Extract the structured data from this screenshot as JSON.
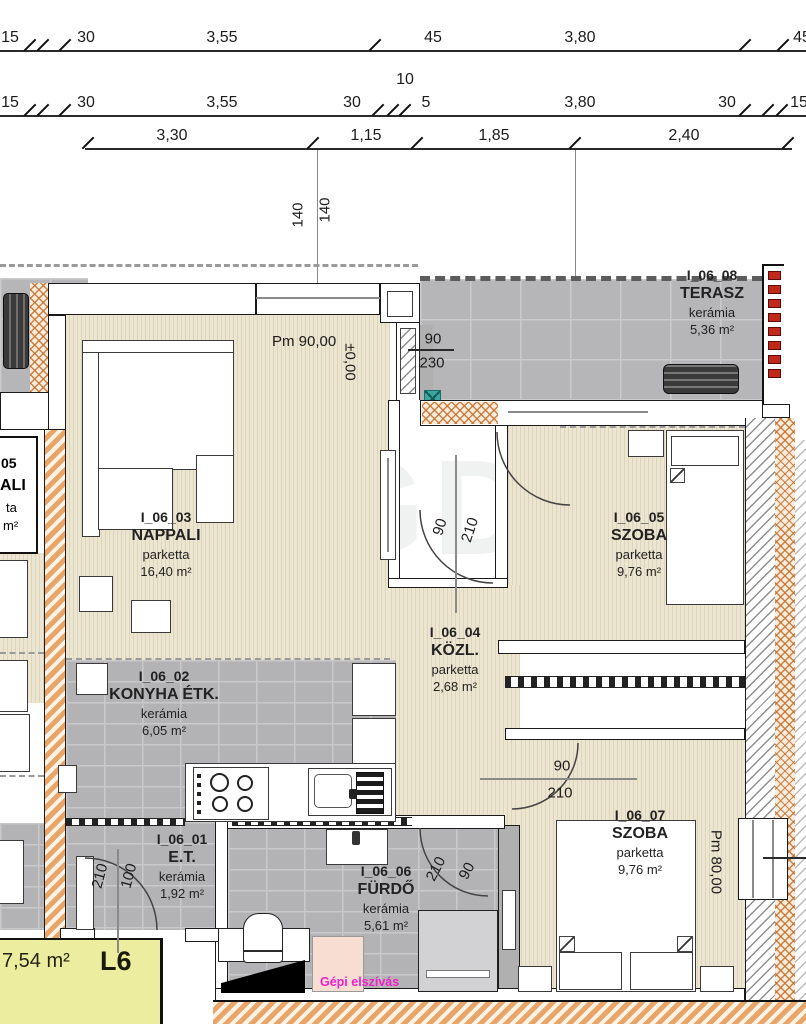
{
  "watermark": "GDN",
  "dims": {
    "row1": [
      "15",
      "30",
      "3,55",
      "45",
      "3,80",
      "45"
    ],
    "between": "10",
    "row2": [
      "15",
      "30",
      "3,55",
      "30",
      "5",
      "3,80",
      "30",
      "15"
    ],
    "row3": [
      "3,30",
      "1,15",
      "1,85",
      "2,40"
    ],
    "v140a": "140",
    "v140b": "140",
    "v230": "230",
    "v200": "200"
  },
  "levels": {
    "pm90": "Pm 90,00",
    "zero": "±0,00",
    "pm80": "Pm 80,00"
  },
  "doors": {
    "terasz": {
      "a": "90",
      "b": "230"
    },
    "nappali": {
      "a": "90",
      "b": "210"
    },
    "szoba07": {
      "a": "90",
      "b": "210"
    },
    "furdo": {
      "a": "210",
      "b": "90"
    },
    "entry": {
      "a": "210",
      "b": "100"
    }
  },
  "rooms": {
    "nappali": {
      "id": "I_06_03",
      "name": "NAPPALI",
      "floor": "parketta",
      "area": "16,40 m²"
    },
    "konyha": {
      "id": "I_06_02",
      "name": "KONYHA ÉTK.",
      "floor": "kerámia",
      "area": "6,05 m²"
    },
    "et": {
      "id": "I_06_01",
      "name": "E.T.",
      "floor": "kerámia",
      "area": "1,92 m²"
    },
    "kozl": {
      "id": "I_06_04",
      "name": "KÖZL.",
      "floor": "parketta",
      "area": "2,68 m²"
    },
    "szoba05": {
      "id": "I_06_05",
      "name": "SZOBA",
      "floor": "parketta",
      "area": "9,76 m²"
    },
    "furdo": {
      "id": "I_06_06",
      "name": "FÜRDŐ",
      "floor": "kerámia",
      "area": "5,61 m²"
    },
    "szoba07": {
      "id": "I_06_07",
      "name": "SZOBA",
      "floor": "parketta",
      "area": "9,76 m²"
    },
    "terasz": {
      "id": "I_06_08",
      "name": "TERASZ",
      "floor": "kerámia",
      "area": "5,36 m²"
    }
  },
  "neighbor": {
    "f1": "05",
    "f2": "ALI",
    "f3": "ta",
    "f4": "m²"
  },
  "loggia": {
    "area": "7,54 m²",
    "code": "L6"
  },
  "note": "Gépi elszívás",
  "colors": {
    "railing": "#c0281c",
    "loggia_fill": "#ededa0",
    "note_color": "#f020c8",
    "parquet": "#e9e3cd",
    "ceramic_tile": "#b3b3b5",
    "insulation": "#e9a468"
  }
}
